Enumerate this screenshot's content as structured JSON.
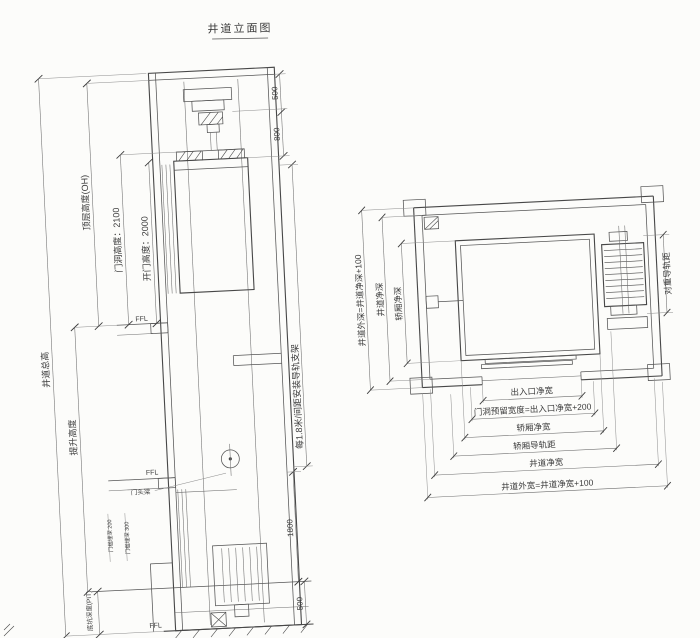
{
  "title": "井道立面图",
  "elevation": {
    "shaft_total_height": "井道总高",
    "travel_height": "提升高度",
    "overhead": "顶层高度(OH)",
    "door_opening_height": "门洞高度：2100",
    "open_door_height": "开门高度：2000",
    "pit_depth": "底坑深度(PIT)",
    "dim_500_top": "500",
    "dim_800": "800",
    "rail_bracket_note": "每1.8米/间距安装导轨支架",
    "dim_1800": "1800",
    "dim_500_bottom": "500",
    "ffl_upper": "FFL",
    "ffl_middle": "FFL",
    "ffl_lower": "FFL",
    "door_header": "门头梁",
    "sill_note_1": "门槛埋深 200",
    "sill_note_2": "门槛埋深 300"
  },
  "plan": {
    "entrance_clear_width": "出入口净宽",
    "door_reserved_width": "门洞预留宽度=出入口净宽+200",
    "car_clear_width": "轿厢净宽",
    "car_rail_distance": "轿厢导轨距",
    "shaft_clear_width": "井道净宽",
    "shaft_outer_width": "井道外宽=井道净宽+100",
    "car_clear_depth": "轿厢净深",
    "shaft_clear_depth": "井道净深",
    "shaft_outer_depth": "井道外深=井道净深+100",
    "counterweight_rail_distance": "对重导轨距"
  },
  "colors": {
    "paper": "#fcfcfa",
    "line": "#474747",
    "text": "#3c3c3c"
  }
}
